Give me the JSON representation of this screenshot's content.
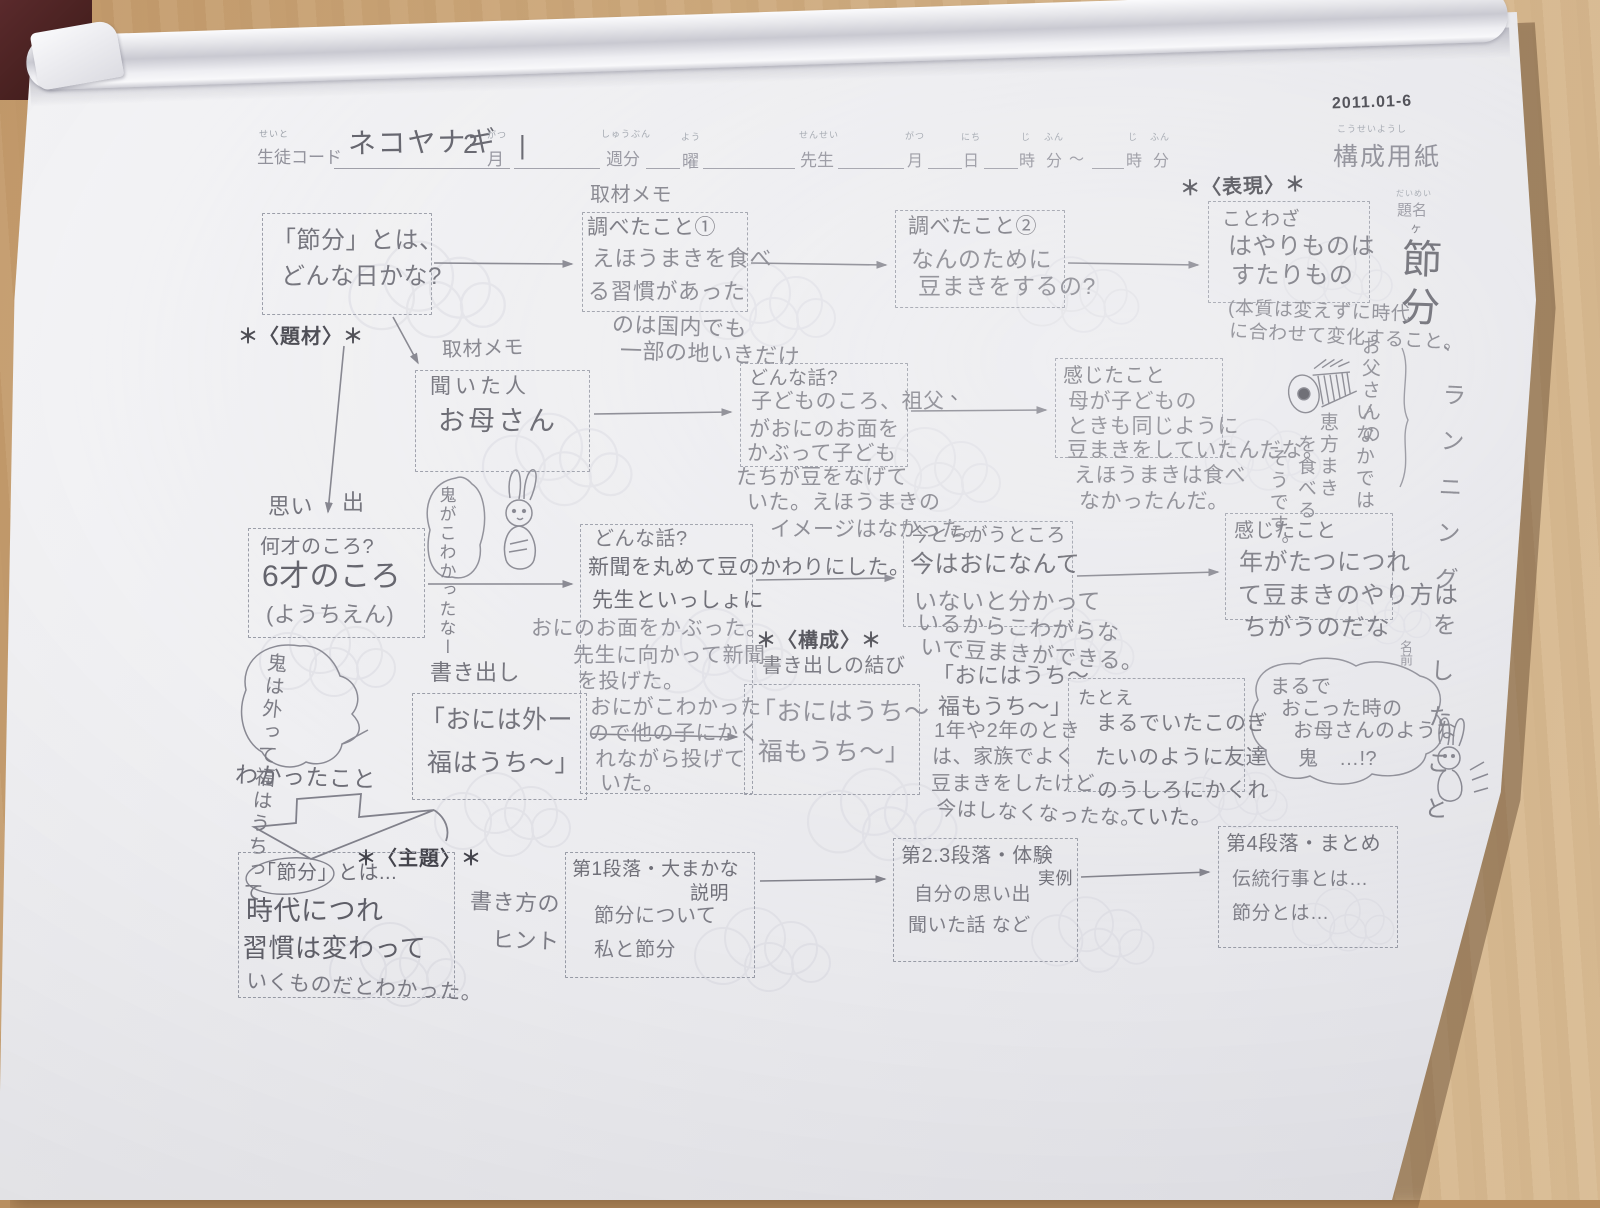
{
  "form": {
    "corner_code": "2011.01-6",
    "code_furigana": "せいと",
    "code_label": "生徒コード",
    "code_value": "ネコヤナギ",
    "month_value": "2",
    "month_furigana": "がつ",
    "month_label": "月",
    "week_value": "|",
    "week_furigana": "しゅうぶん",
    "week_label": "週分",
    "day_furigana": "よう",
    "day_label": "曜",
    "teacher_furigana": "せんせい",
    "teacher_label": "先生",
    "date_month_furigana": "がつ",
    "date_month": "月",
    "date_day_furigana": "にち",
    "date_day": "日",
    "date_hour_furigana": "じ",
    "date_hour": "時",
    "date_min_furigana": "ふん",
    "date_min": "分",
    "tilde": "〜",
    "date_hour2_furigana": "じ",
    "date_hour2": "時",
    "date_min2_furigana": "ふん",
    "date_min2": "分",
    "sheet_title_furigana": "こうせいようし",
    "sheet_title": "構成用紙",
    "title_furigana": "だいめい",
    "title_label": "題名",
    "name_label": "名前"
  },
  "tags": {
    "hyogen": "＊〈表現〉＊",
    "daizai": "＊〈題材〉＊",
    "kousei": "＊〈構成〉＊",
    "shudai": "＊〈主題〉＊"
  },
  "labels": {
    "memo1": "取材メモ",
    "memo2": "取材メモ",
    "omoide_a": "思い",
    "omoide_b": "出",
    "kakidashi": "書き出し",
    "musubi": "書き出しの結び",
    "wakatta": "わかったこと",
    "hint1": "書き方の",
    "hint2": "ヒント",
    "stray_comma": "、"
  },
  "boxes": {
    "q": {
      "l1": "「節分」とは、",
      "l2": "どんな日かな?"
    },
    "s1": {
      "label": "調べたこと①",
      "l1": "えほうまきを食べ",
      "l2": "る習慣があった",
      "l3": "のは国内でも",
      "l4": "一部の地いきだけ"
    },
    "s2": {
      "label": "調べたこと②",
      "l1": "なんのために",
      "l2": "豆まきをするの?"
    },
    "kotowaza": {
      "label": "ことわざ",
      "l1": "はやりものは",
      "l2": "すたりもの",
      "note1": "(本質は変えずに時代",
      "note2": "に合わせて変化すること。"
    },
    "interview": {
      "label": "聞いた人",
      "value": "お母さん"
    },
    "story1": {
      "label": "どんな話?",
      "l1": "子どものころ、祖父",
      "l2": "がおにのお面を",
      "l3": "かぶって子ども",
      "l4": "たちが豆をなげて",
      "l5": "いた。えほうまきの",
      "l6": "イメージはなかった。"
    },
    "felt1": {
      "label": "感じたこと",
      "l1": "母が子どもの",
      "l2": "ときも同じように",
      "l3": "豆まきをしていたんだな。",
      "l4": "えほうまきは食べ",
      "l5": "なかったんだ。"
    },
    "age": {
      "label": "何才のころ?",
      "l1": "6才のころ",
      "l2": "(ようちえん)"
    },
    "story2": {
      "label": "どんな話?",
      "l1": "新聞を丸めて豆のかわりにした。",
      "l2": "先生といっしょに",
      "l3": "おにのお面をかぶった。",
      "l4": "先生に向かって新聞",
      "l5": "を投げた。",
      "l6": "おにがこわかった",
      "l7": "ので他の子にかく",
      "l8": "れながら投げて",
      "l9": "いた。"
    },
    "now": {
      "label": "今とちがうところ",
      "l1": "今はおになんて",
      "l2": "いないと分かって",
      "l3": "いるからこわがらな",
      "l4": "いで豆まきができる。"
    },
    "felt2": {
      "label": "感じたこと",
      "l1": "年がたつにつれ",
      "l2": "て豆まきのやり方は",
      "l3": "ちがうのだな"
    },
    "opening": {
      "l1": "「おには外ー",
      "l2": "福はうち〜」"
    },
    "closing": {
      "l1": "「おにはうち〜",
      "l2": "福もうち〜」"
    },
    "repeat": {
      "l1": "「おにはうち〜",
      "l2": "福もうち〜」",
      "l3": "1年や2年のとき",
      "l4": "は、家族でよく",
      "l5": "豆まきをしたけど",
      "l6": "今はしなくなったな。"
    },
    "simile": {
      "label": "たとえ",
      "l1": "まるでいたこのぎ",
      "l2": "たいのように友達",
      "l3": "のうしろにかくれ",
      "l4": "ていた。"
    },
    "theme": {
      "l1": "「節分」とは...",
      "l2": "時代につれ",
      "l3": "習慣は変わって",
      "l4": "いくものだとわかった。"
    },
    "p1": {
      "l1": "第1段落・大まかな",
      "l2": "説明",
      "l3": "節分について",
      "l4": "私と節分"
    },
    "p23": {
      "l1": "第2.3段落・体験",
      "l2": "実例",
      "l3": "自分の思い出",
      "l4": "聞いた話 など"
    },
    "p4": {
      "l1": "第4段落・まとめ",
      "l2": "伝統行事とは…",
      "l3": "節分とは…"
    }
  },
  "bubbles": {
    "scared": "鬼がこわかったなー",
    "chant": "鬼は外って福はうちって",
    "marude": {
      "l1": "まるで",
      "l2": "おこった時の",
      "l3": "お母さんのような",
      "l4": "鬼　…!?"
    },
    "ehomaki": {
      "c1": "お父さんの",
      "c2": "いなかでは",
      "c3": "恵方まき",
      "c4": "を食べる",
      "c5": "そうです。"
    }
  },
  "margin": {
    "title_vert": "節分",
    "small_mark": "ヶ",
    "comma": "、",
    "note": "ランニングをしたこと"
  }
}
